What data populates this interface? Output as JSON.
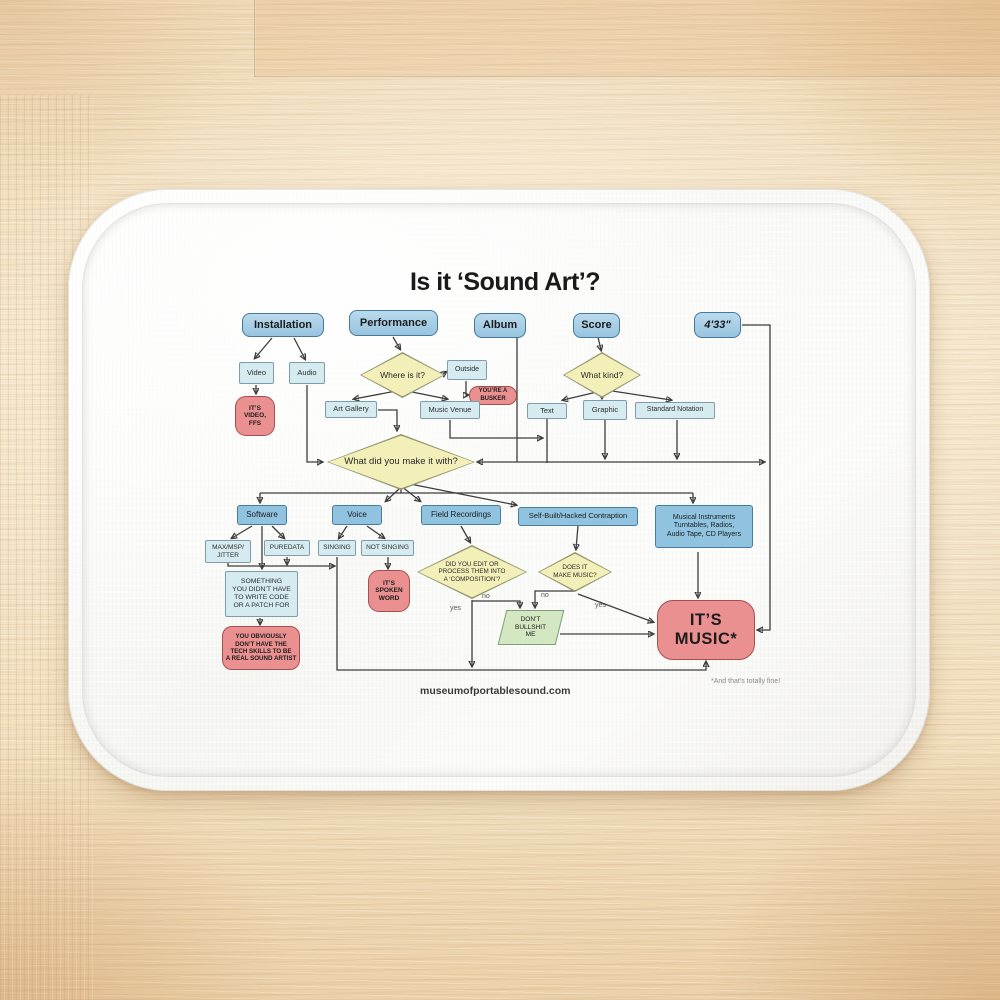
{
  "title": "Is it ‘Sound Art’?",
  "footer": {
    "url": "museumofportablesound.com",
    "footnote": "*And that’s totally fine!"
  },
  "edge_labels": {
    "no_composition": "no",
    "yes_composition": "yes",
    "no_music": "no",
    "yes_music": "yes"
  },
  "nodes": {
    "installation": {
      "label": "Installation"
    },
    "performance": {
      "label": "Performance"
    },
    "album": {
      "label": "Album"
    },
    "score": {
      "label": "Score"
    },
    "four33": {
      "label": "4'33\""
    },
    "video": {
      "label": "Video"
    },
    "audio": {
      "label": "Audio"
    },
    "outside": {
      "label": "Outside"
    },
    "videoffs": {
      "label": "IT’S\nVIDEO,\nFFS"
    },
    "busker": {
      "label": "YOU’RE A\nBUSKER"
    },
    "where": {
      "label": "Where is it?"
    },
    "whatkind": {
      "label": "What kind?"
    },
    "artgallery": {
      "label": "Art Gallery"
    },
    "musicvenue": {
      "label": "Music Venue"
    },
    "textnode": {
      "label": "Text"
    },
    "graphic": {
      "label": "Graphic"
    },
    "stdnotation": {
      "label": "Standard Notation"
    },
    "makewith": {
      "label": "What did you make it with?"
    },
    "software": {
      "label": "Software"
    },
    "voice": {
      "label": "Voice"
    },
    "fieldrec": {
      "label": "Field Recordings"
    },
    "selfbuilt": {
      "label": "Self-Built/Hacked Contraption"
    },
    "instruments": {
      "label": "Musical Instruments\nTurntables, Radios,\nAudio Tape, CD Players"
    },
    "maxmsp": {
      "label": "MAX/MSP/\nJITTER"
    },
    "puredata": {
      "label": "PUREDATA"
    },
    "singing": {
      "label": "SINGING"
    },
    "notsinging": {
      "label": "NOT SINGING"
    },
    "something": {
      "label": "SOMETHING\nYOU DIDN’T HAVE\nTO WRITE CODE\nOR A PATCH FOR"
    },
    "noskills": {
      "label": "YOU OBVIOUSLY\nDON’T HAVE THE\nTECH SKILLS TO BE\nA REAL SOUND ARTIST"
    },
    "spoken": {
      "label": "IT’S\nSPOKEN\nWORD"
    },
    "didedit": {
      "label": "DID YOU EDIT OR\nPROCESS THEM INTO\nA ‘COMPOSITION’?"
    },
    "makemusic": {
      "label": "DOES IT\nMAKE MUSIC?"
    },
    "dbm": {
      "label": "DON’T\nBULLSHIT\nME"
    },
    "itsmusic": {
      "label": "IT’S\nMUSIC*"
    }
  },
  "colors": {
    "node_blue": "#a6cee6",
    "node_blue_mid": "#8fc3e0",
    "node_light": "#d6ebef",
    "diamond_yellow": "#f3efb8",
    "node_red": "#ea9090",
    "parallelogram_green": "#d2e7c2",
    "line": "#3d3d3d"
  }
}
